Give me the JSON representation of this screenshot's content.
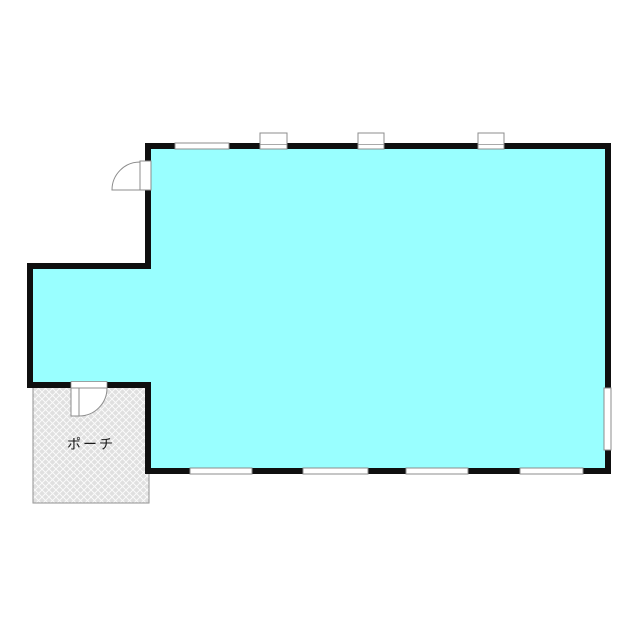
{
  "floorplan": {
    "porch_label": "ポーチ",
    "colors": {
      "room_fill": "#99ffff",
      "wall": "#0f0f0f",
      "fixture_stroke": "#8c8c8c",
      "fixture_fill": "#ffffff",
      "porch_fill": "#e0e0e0",
      "porch_hatch": "#fafafa",
      "porch_border": "#909090",
      "label": "#1a1a1a"
    }
  }
}
